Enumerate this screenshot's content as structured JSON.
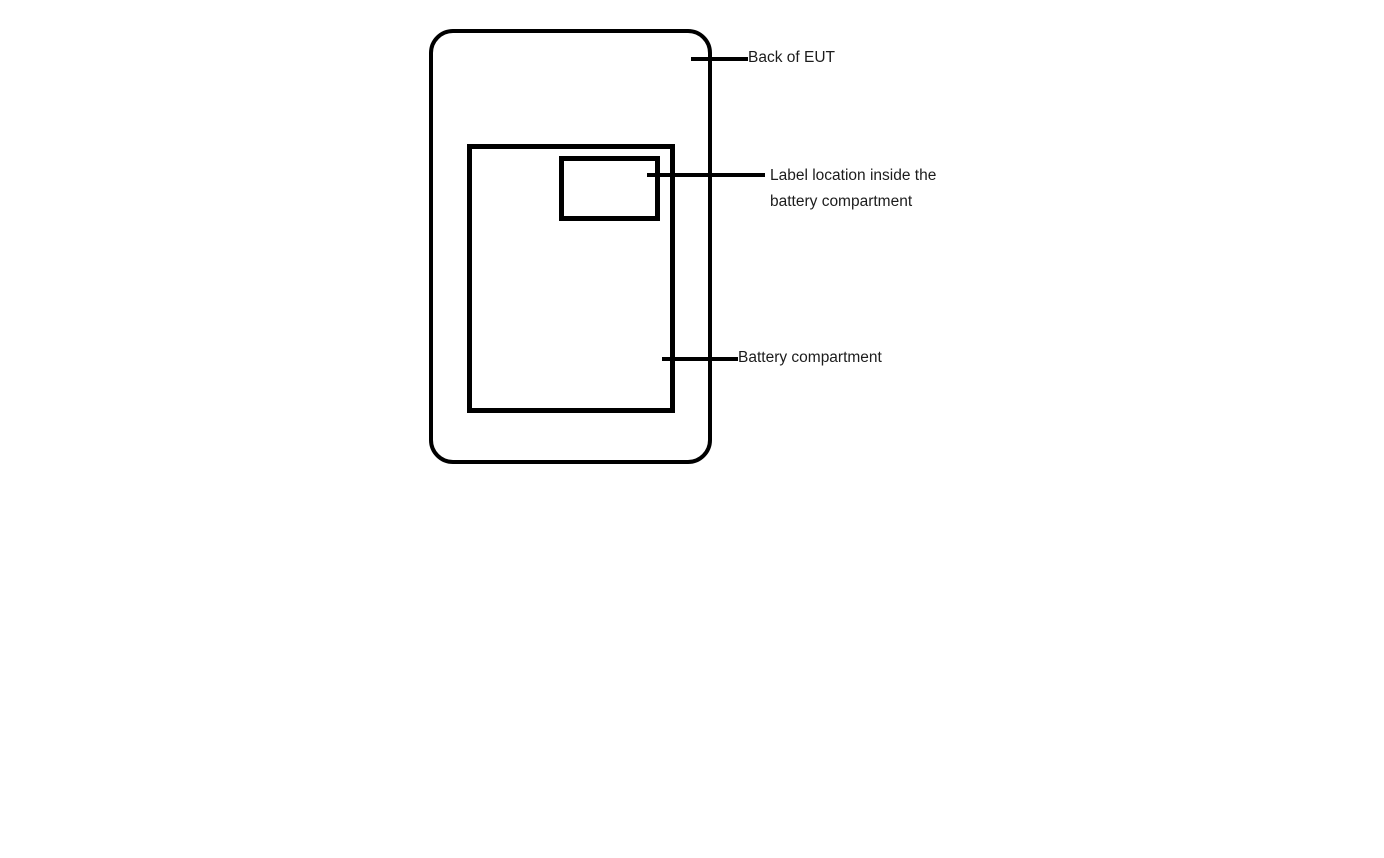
{
  "diagram": {
    "background_color": "#ffffff",
    "line_color": "#000000",
    "text_color": "#1c1c1c",
    "annotations": {
      "back_of_eut": "Back of EUT",
      "label_location_line1": "Label location inside the",
      "label_location_line2": "battery compartment",
      "battery_compartment": "Battery compartment"
    }
  }
}
